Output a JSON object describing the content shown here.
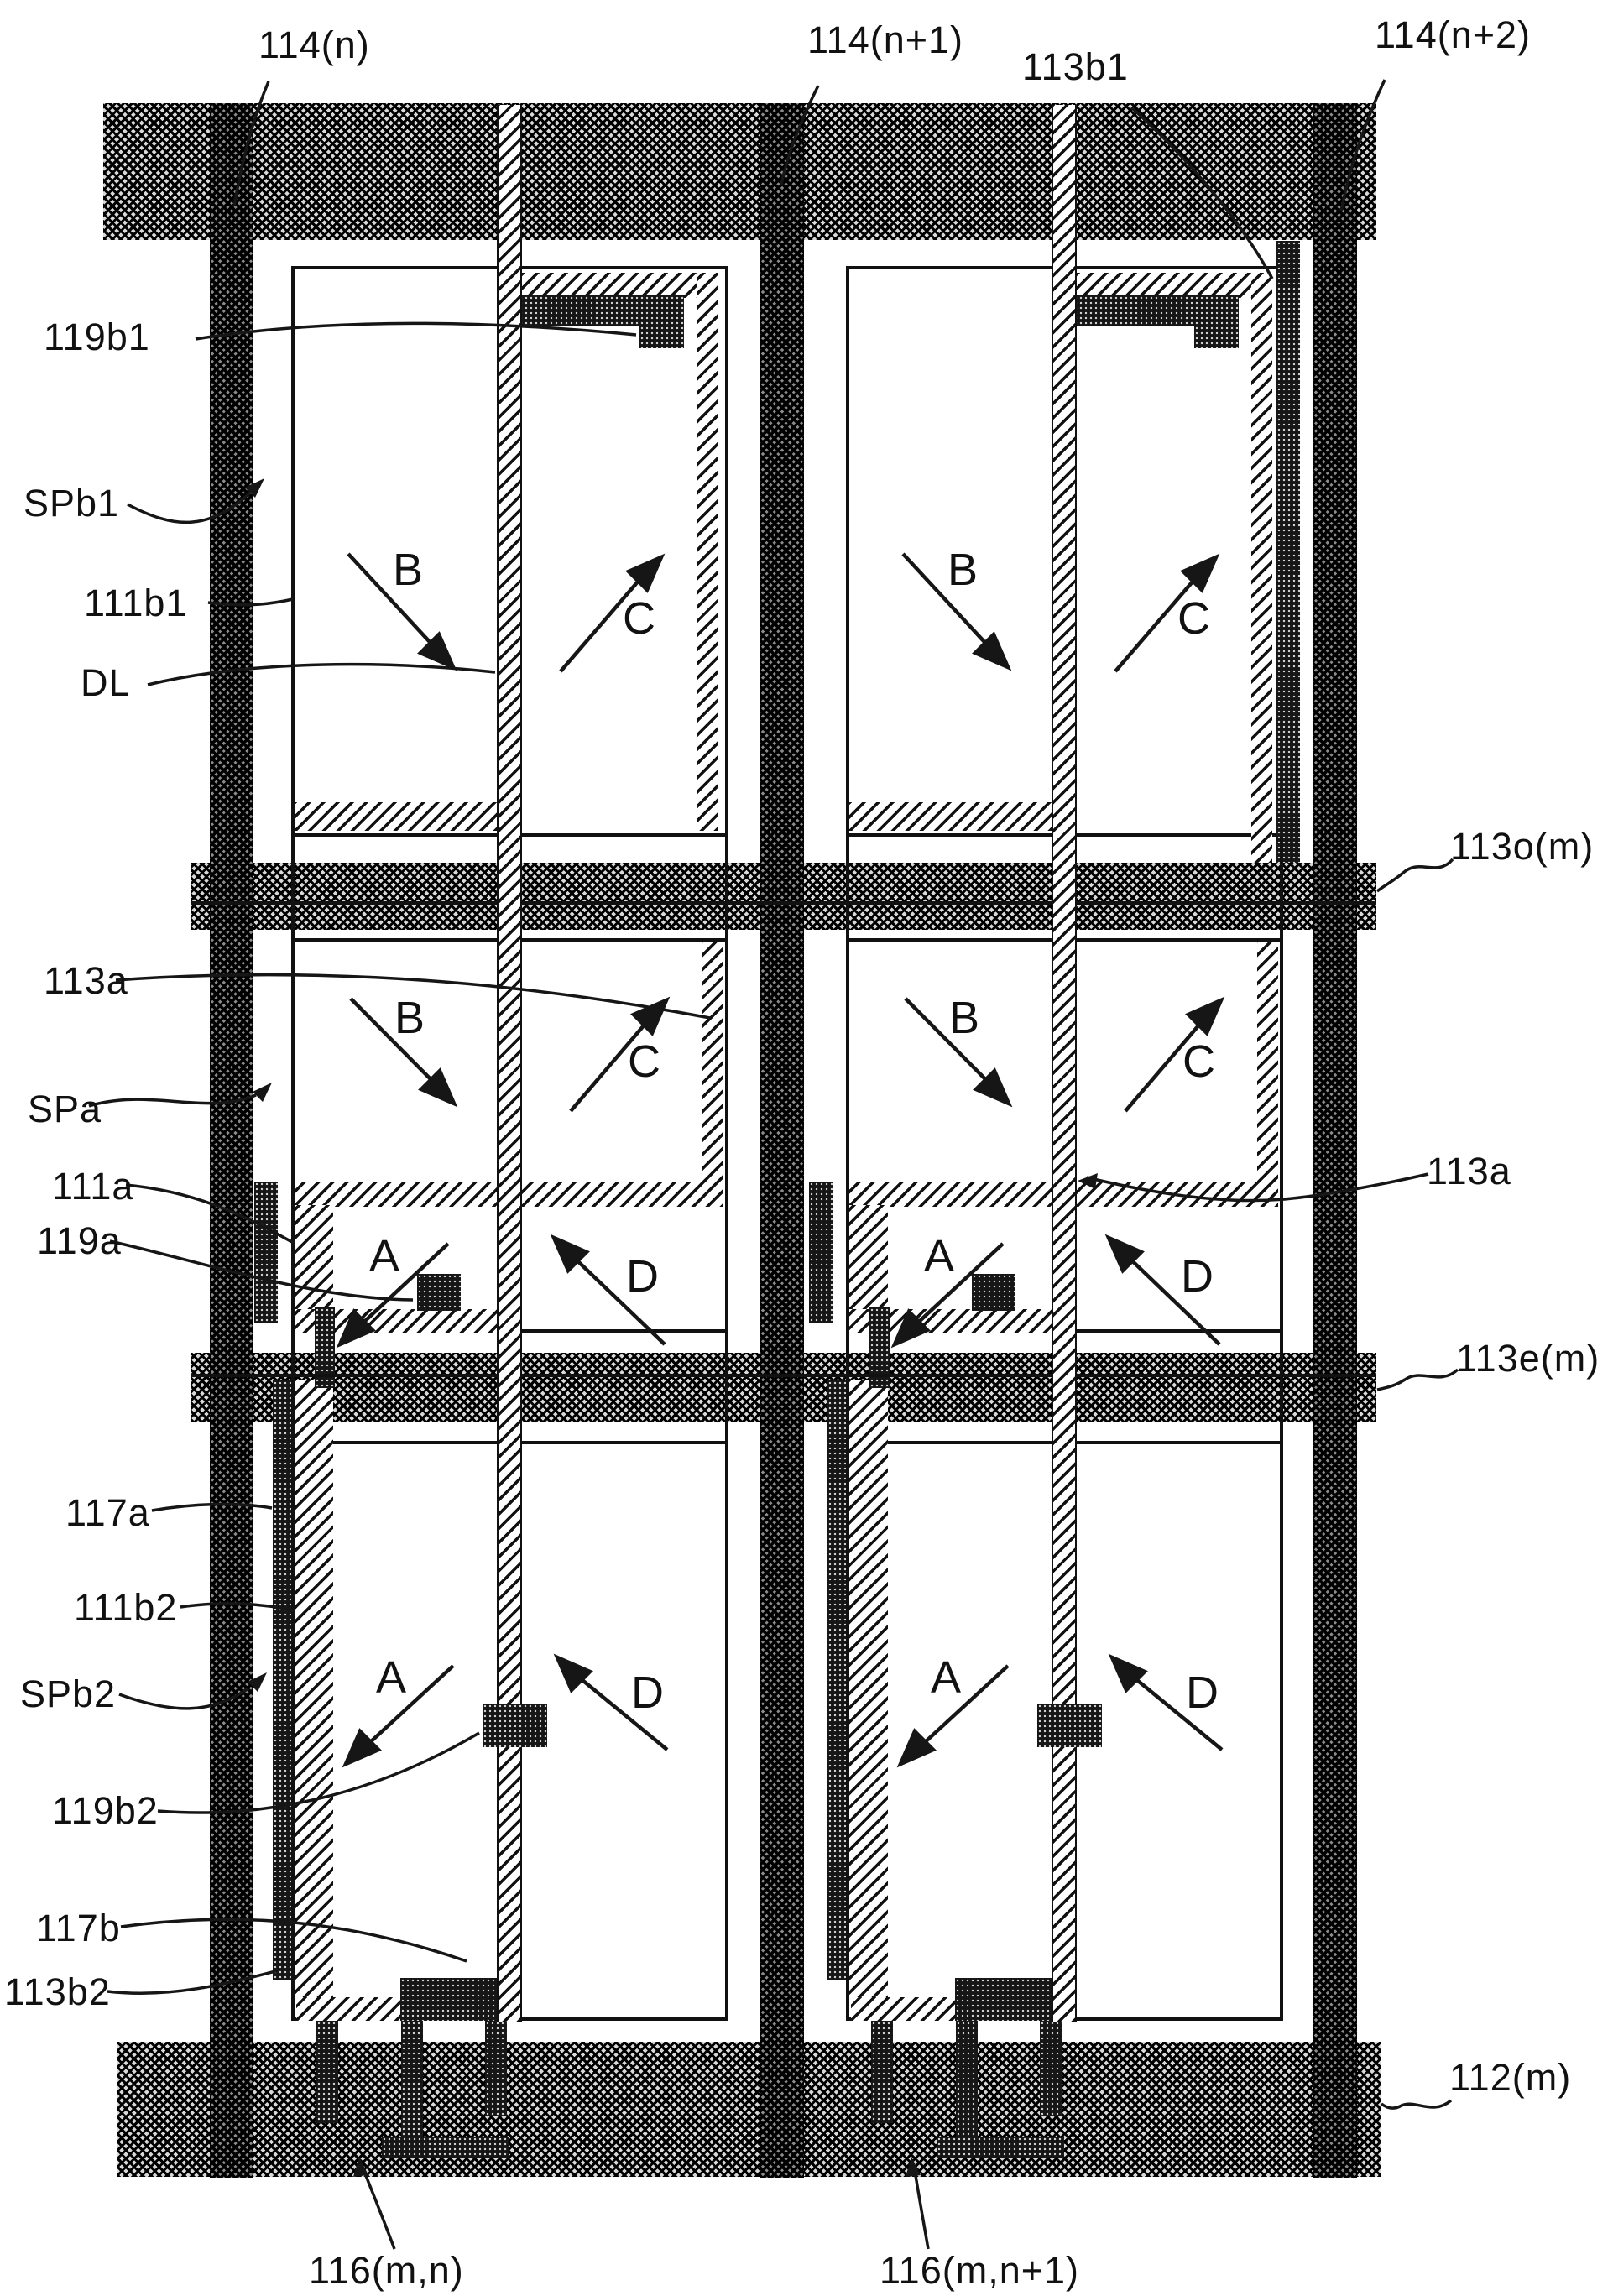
{
  "figure": {
    "title": "TFT pixel array layout (patent drawing)",
    "colors": {
      "ink": "#111111",
      "paper": "#ffffff"
    },
    "labels": {
      "gate_n": "114(n)",
      "gate_n1": "114(n+1)",
      "cap_b1": "113b1",
      "gate_n2": "114(n+2)",
      "l119b1": "119b1",
      "spb1": "SPb1",
      "l111b1": "111b1",
      "dl": "DL",
      "l113a_left": "113a",
      "spa": "SPa",
      "l111a": "111a",
      "l119a": "119a",
      "l113o": "113o(m)",
      "l113a_right": "113a",
      "l113e": "113e(m)",
      "l117a": "117a",
      "l111b2": "111b2",
      "spb2": "SPb2",
      "l119b2": "119b2",
      "l117b": "117b",
      "l113b2": "113b2",
      "l112": "112(m)",
      "t116mn": "116(m,n)",
      "t116mn1": "116(m,n+1)",
      "dirA": "A",
      "dirB": "B",
      "dirC": "C",
      "dirD": "D"
    }
  }
}
